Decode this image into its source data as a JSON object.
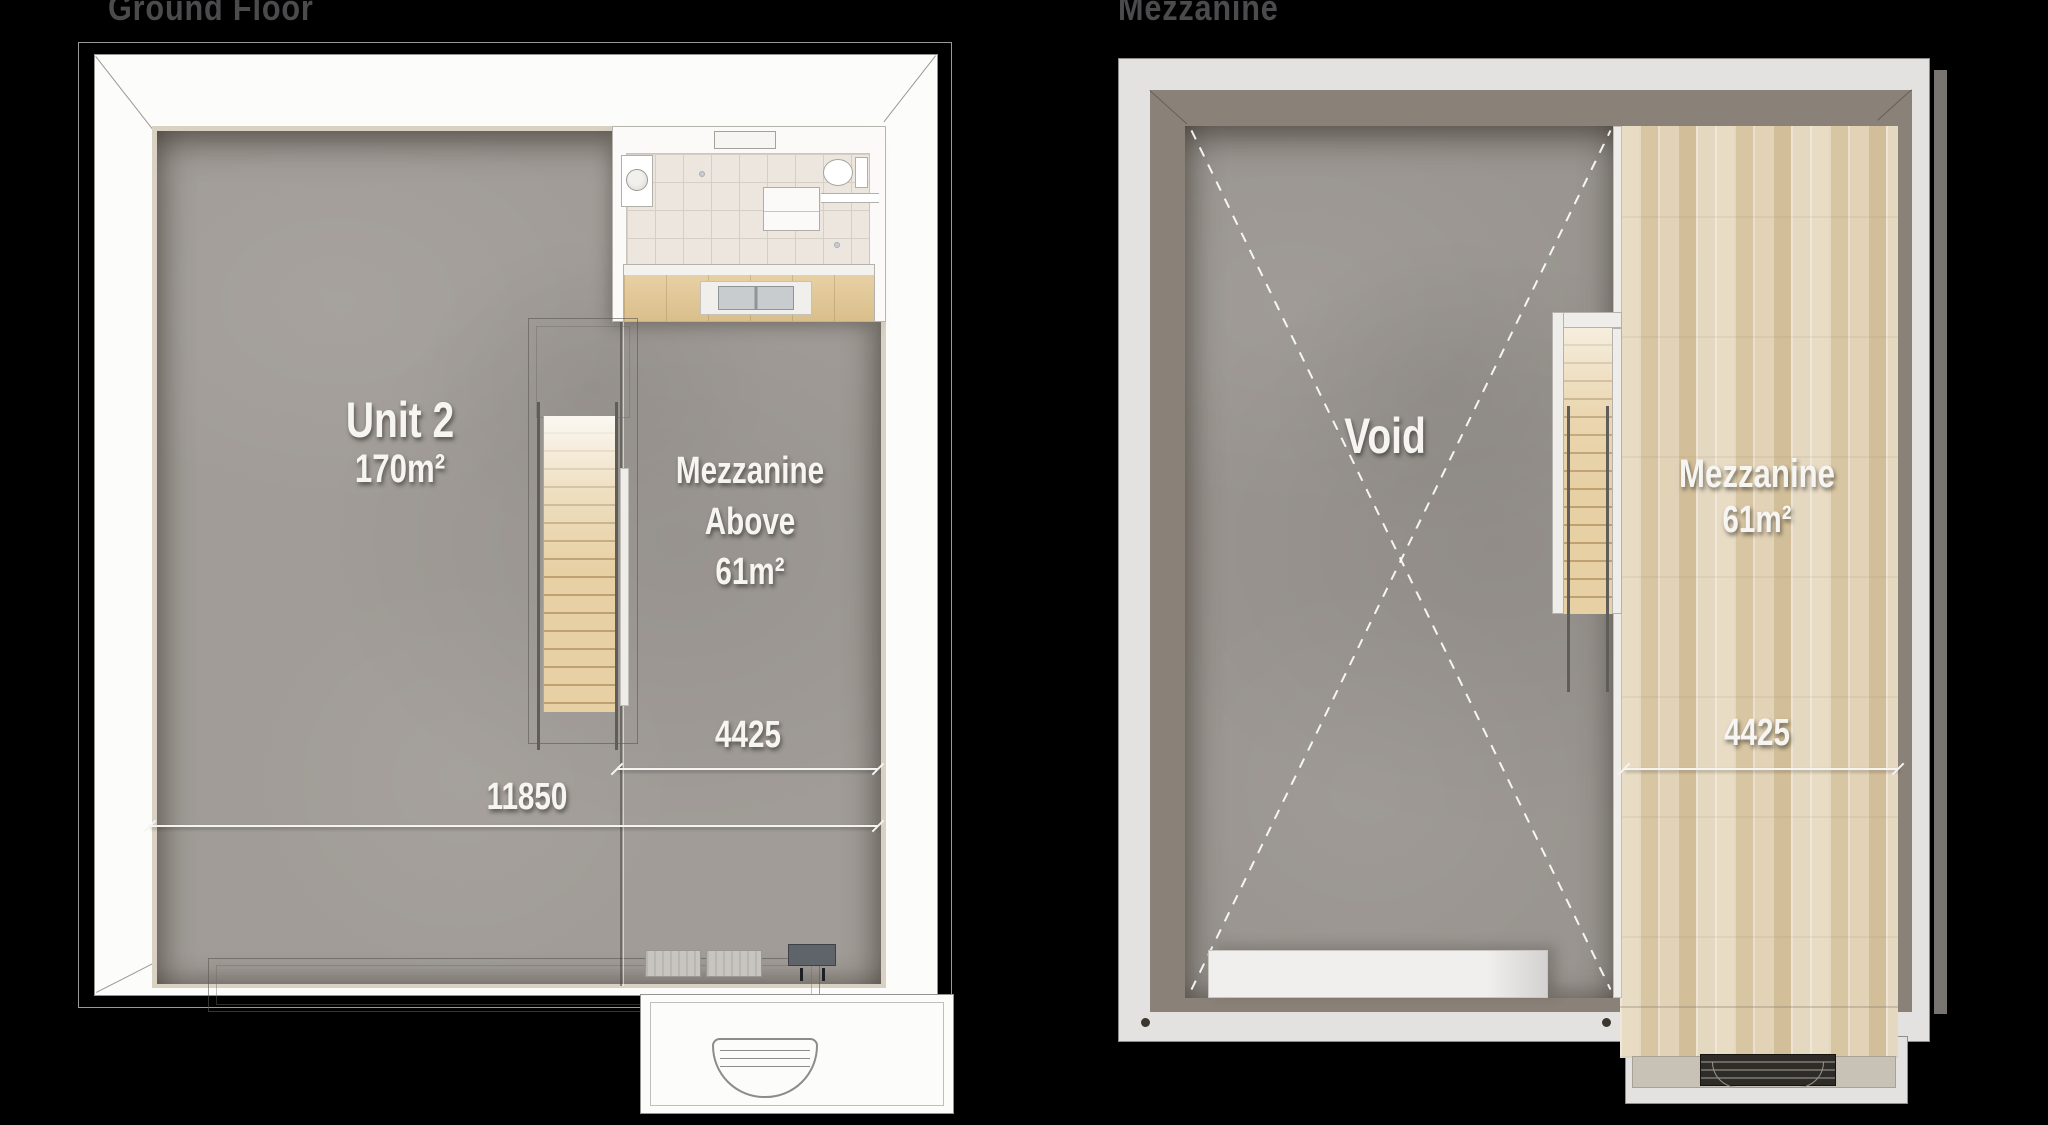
{
  "header": {
    "left_title": "Ground Floor",
    "right_title": "Mezzanine"
  },
  "ground_floor": {
    "unit": {
      "name": "Unit 2",
      "area": "170m²"
    },
    "mezzanine_above": {
      "line1": "Mezzanine",
      "line2": "Above",
      "area": "61m²"
    },
    "dimensions": {
      "mezzanine_width": "4425",
      "total_width": "11850"
    }
  },
  "mezzanine_floor": {
    "void_label": "Void",
    "mezzanine": {
      "name": "Mezzanine",
      "area": "61m²"
    },
    "dimensions": {
      "mezzanine_width": "4425"
    }
  },
  "colors": {
    "c-bg": "#000000",
    "c-title": "#4b4b4d",
    "c-label": "#f6f5f2",
    "c-concrete": "#a19c97",
    "c-cream": "#d8d1c4",
    "c-wall-white": "#fcfcfb",
    "c-tile": "#ece6de",
    "c-grout": "#d6cfc6",
    "c-wood-light": "#e7d0a4",
    "c-wood-dark": "#bfa171",
    "c-gray-outer": "#e4e2e0",
    "c-gray-face": "#8a8178",
    "c-rail": "#5f5d5a",
    "c-dim": "#f5f4f1"
  }
}
